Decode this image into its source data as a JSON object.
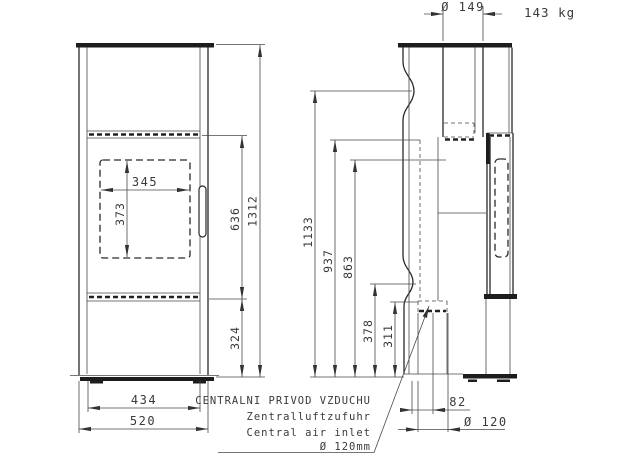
{
  "header": {
    "weight": "143 kg"
  },
  "front_view": {
    "glass_width": "345",
    "glass_height": "373",
    "firebox_zone_height": "636",
    "total_height": "1312",
    "plinth_height": "324",
    "inner_width": "434",
    "overall_width": "520"
  },
  "side_view": {
    "flue_diameter": "Ø 149",
    "rear_outlet_height": "1133",
    "height_937": "937",
    "height_863": "863",
    "height_378": "378",
    "height_311": "311",
    "inlet_offset": "82",
    "inlet_diameter": "Ø 120"
  },
  "air_inlet_note": {
    "line_czech": "CENTRALNI PRIVOD VZDUCHU",
    "line_german": "Zentralluftzufuhr",
    "line_english": "Central air inlet",
    "diameter": "Ø 120mm"
  }
}
